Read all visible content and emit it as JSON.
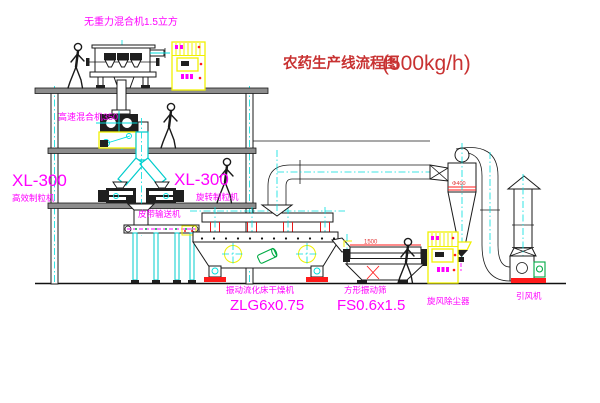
{
  "title": {
    "name": "农药生产线流程图",
    "capacity": "(500kg/h)"
  },
  "labels": {
    "gravity_mixer": "无重力混合机1.5立方",
    "high_speed_mixer": "高速混合机350",
    "granulator_left_model": "XL-300",
    "granulator_left_name": "高效制粒机",
    "granulator_right_model": "XL-300",
    "granulator_right_name": "旋转制粒机",
    "belt_conveyor": "皮带输送机",
    "dryer_name": "振动流化床干燥机",
    "dryer_model": "ZLG6x0.75",
    "screen_name": "方形振动筛",
    "screen_model": "FS0.6x1.5",
    "cyclone": "旋风除尘器",
    "fan": "引风机"
  },
  "dimensions": {
    "screen_length": "1500",
    "cyclone_dia": "Φ400"
  },
  "colors": {
    "label_magenta": "#ff00ff",
    "title_red": "#c83232",
    "centerline_cyan": "#00dede",
    "cabinet_yellow": "#f0f000",
    "alert_red": "#ff1a1a",
    "machine_green": "#00aa44"
  }
}
